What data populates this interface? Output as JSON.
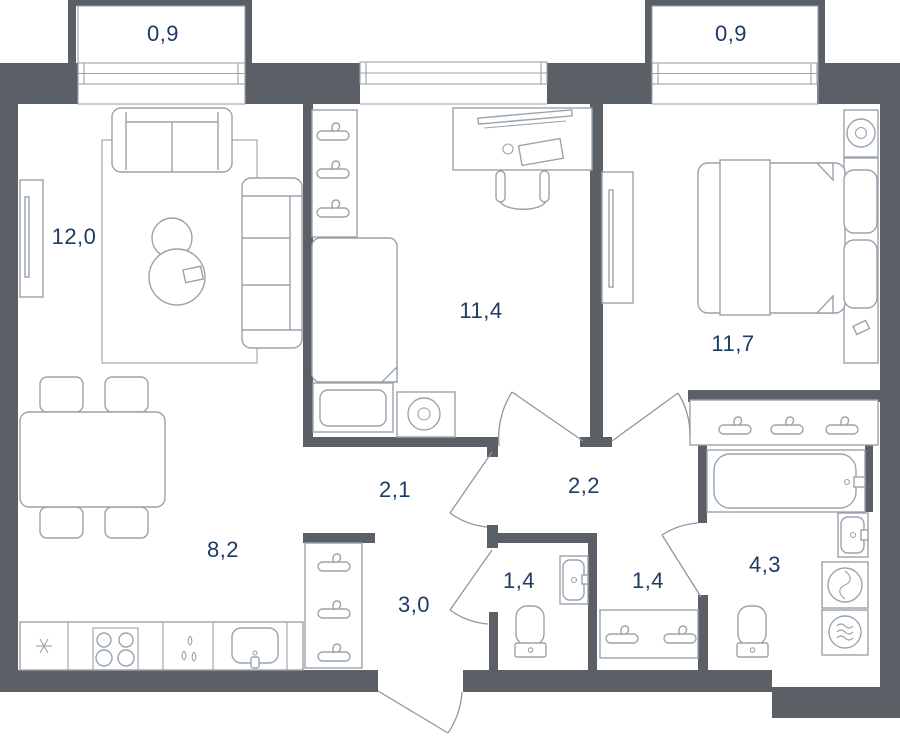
{
  "colors": {
    "wall": "#5a6066",
    "furniture_line": "#9aa3ab",
    "door_line": "#8f979e",
    "label_text": "#1e3b63",
    "background": "#ffffff"
  },
  "plan": {
    "type": "apartment-floor-plan",
    "area_unit_format": "comma-decimal",
    "rooms": [
      {
        "id": "balcony-left",
        "area_label": "0,9"
      },
      {
        "id": "living-room",
        "area_label": "12,0"
      },
      {
        "id": "study-bedroom",
        "area_label": "11,4"
      },
      {
        "id": "bedroom",
        "area_label": "11,7"
      },
      {
        "id": "balcony-right",
        "area_label": "0,9"
      },
      {
        "id": "hallway",
        "area_label": "2,1"
      },
      {
        "id": "hall",
        "area_label": "2,2"
      },
      {
        "id": "kitchen-dining",
        "area_label": "8,2"
      },
      {
        "id": "corridor",
        "area_label": "3,0"
      },
      {
        "id": "toilet",
        "area_label": "1,4"
      },
      {
        "id": "dressing",
        "area_label": "1,4"
      },
      {
        "id": "bathroom",
        "area_label": "4,3"
      }
    ],
    "furniture_icons": [
      "sofa",
      "loveseat",
      "tv-console",
      "rug",
      "round-coffee-tables",
      "dining-table",
      "chairs",
      "fridge-snowflake",
      "stove-burners",
      "kitchen-sink",
      "utensil-drops",
      "wardrobe-hangers",
      "single-bed",
      "dresser",
      "lamp-table",
      "desk",
      "desk-chair",
      "double-bed",
      "pillows",
      "nightstand-lamp",
      "bathtub",
      "washbasin",
      "washing-machine",
      "dryer",
      "toilet",
      "door-swing",
      "window"
    ]
  }
}
